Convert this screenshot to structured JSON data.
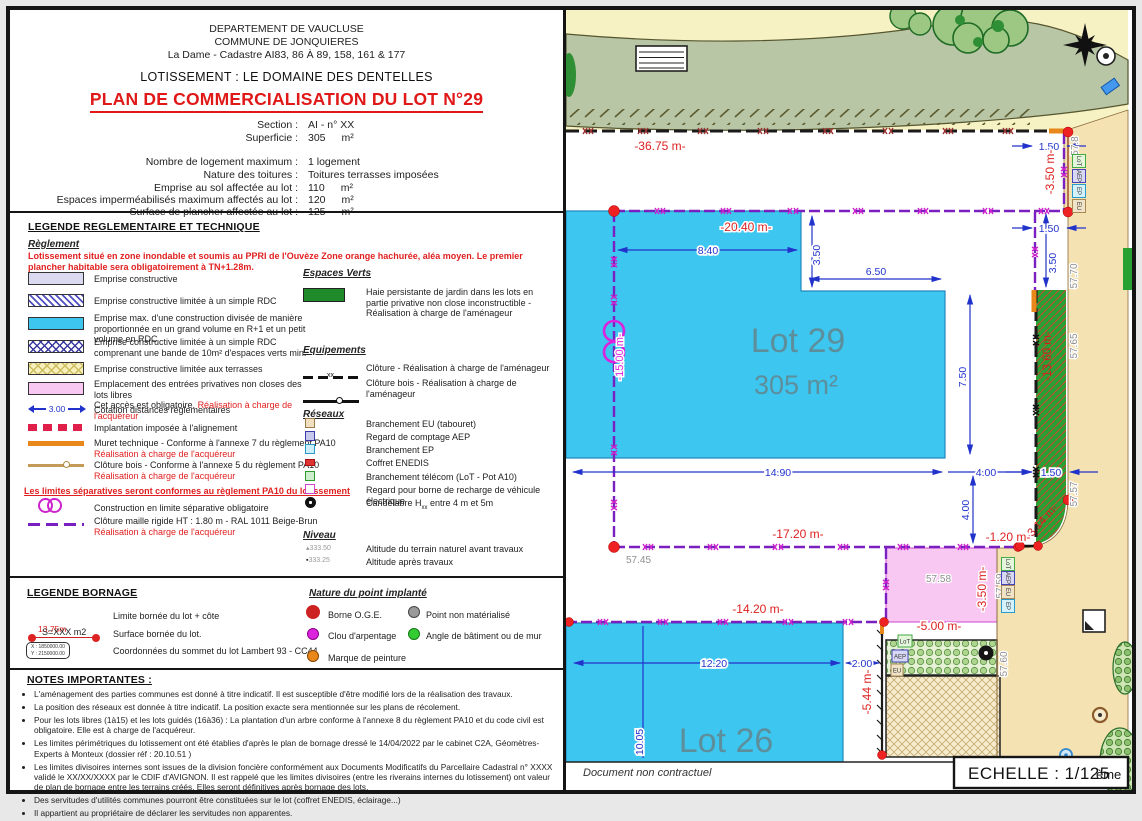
{
  "doc": {
    "dept": "DEPARTEMENT DE VAUCLUSE",
    "commune": "COMMUNE DE JONQUIERES",
    "cadastre": "La Dame - Cadastre AI83, 86 À 89, 158, 161 & 177",
    "lotissement": "LOTISSEMENT : LE DOMAINE DES DENTELLES",
    "title": "PLAN DE COMMERCIALISATION DU LOT N°29",
    "fields": [
      {
        "label": "Section :",
        "value": "AI - n° XX",
        "unit": ""
      },
      {
        "label": "Superficie :",
        "value": "305",
        "unit": "m²"
      },
      {
        "label": "Nombre de logement maximum :",
        "value": "1 logement",
        "unit": ""
      },
      {
        "label": "Nature des toitures :",
        "value": "Toitures terrasses imposées",
        "unit": ""
      },
      {
        "label": "Emprise au sol affectée au lot :",
        "value": "110",
        "unit": "m²"
      },
      {
        "label": "Espaces imperméabilisés maximum affectés au lot :",
        "value": "120",
        "unit": "m²"
      },
      {
        "label": "Surface de plancher affectée au lot :",
        "value": "125",
        "unit": "m²"
      }
    ]
  },
  "legend_tech": {
    "title": "LEGENDE REGLEMENTAIRE ET TECHNIQUE",
    "reglement_title": "Règlement",
    "warning": "Lotissement situé en zone inondable et soumis au PPRI de l'Ouvèze Zone orange hachurée, aléa moyen.  Le premier plancher habitable sera obligatoirement à TN+1.28m.",
    "cotation_value": "3.00",
    "items": [
      {
        "text": "Emprise constructive"
      },
      {
        "text": "Emprise constructive limitée à un simple RDC"
      },
      {
        "text": "Emprise max. d'une construction divisée de manière proportionnée en un grand volume en R+1 et un petit volume en RDC"
      },
      {
        "text": "Emprise constructive limitée à un simple RDC comprenant une bande de 10m² d'espaces verts min."
      },
      {
        "text": "Emprise constructive limitée aux terrasses"
      },
      {
        "text": "Emplacement des entrées privatives non closes des lots libres",
        "text2": "Cet accès est obligatoire. ",
        "red": "Réalisation à charge de l'acquéreur"
      },
      {
        "text": "Cotation distances réglementaires"
      },
      {
        "text": "Implantation imposée à l'alignement"
      },
      {
        "text": "Muret technique - Conforme à l'annexe 7 du règlement PA10",
        "red": "Réalisation à charge de l'acquéreur"
      },
      {
        "text": "Clôture bois - Conforme à l'annexe 5 du règlement PA10",
        "red": "Réalisation à charge de l'acquéreur"
      },
      {
        "text": "Construction en limite séparative obligatoire"
      },
      {
        "text": "Clôture maille rigide HT : 1.80 m - RAL 1011 Beige-Brun",
        "red": "Réalisation à charge de l'acquéreur"
      }
    ],
    "sep_note": "Les limites séparatives seront conformes au règlement PA10 du lotissement",
    "espaces_verts": {
      "title": "Espaces Verts",
      "haie": "Haie persistante de jardin dans les lots en partie privative non close inconstructible - Réalisation à charge de l'aménageur"
    },
    "equipements": {
      "title": "Equipements",
      "cloture": "Clôture - Réalisation à charge de l'aménageur",
      "cloture_bois": "Clôture bois - Réalisation à charge de l'aménageur"
    },
    "reseaux": {
      "title": "Réseaux",
      "eu": "Branchement EU (tabouret)",
      "aep": "Regard de comptage AEP",
      "ep": "Branchement EP",
      "enedis": "Coffret ENEDIS",
      "telecom": "Branchement télécom (LoT - Pot A10)",
      "recharge": "Regard pour borne de recharge de véhicule électrique",
      "cand_pre": "Candélabre H",
      "cand_sub": "xx",
      "cand_post": " entre 4 m et 5m"
    },
    "niveau": {
      "title": "Niveau",
      "avant_mark": "333.50",
      "avant": "Altitude du terrain naturel avant travaux",
      "apres_mark": "333.25",
      "apres": "Altitude après travaux"
    }
  },
  "nature_point": {
    "title": "Nature du point implanté",
    "borne": "Borne O.G.E.",
    "clou": "Clou d'arpentage",
    "marque": "Marque de peinture",
    "non_materialise": "Point non matérialisé",
    "angle": "Angle de bâtiment ou de mur"
  },
  "bornage": {
    "title": "LEGENDE BORNAGE",
    "limite_mark": "13.75m",
    "limite": "Limite bornée du lot + côte",
    "surface_mark": "S=XXX m2",
    "surface": "Surface bornée du lot.",
    "coord_x": "X : 1850000.00",
    "coord_y": "Y : 2150000.00",
    "coords": "Coordonnées du sommet du lot Lambert 93 - CC44"
  },
  "notes": {
    "title": "NOTES IMPORTANTES :",
    "bullets": [
      "L'aménagement des parties communes est donné à titre indicatif. Il est susceptible d'être modifié lors de la réalisation des travaux.",
      "La position des réseaux est donnée à titre indicatif. La position exacte sera mentionnée sur les plans de récolement.",
      "Pour les lots libres (1à15) et les lots guidés (16à36) : La plantation d'un arbre conforme à l'annexe 8 du règlement PA10 et du code civil est obligatoire. Elle est à charge de l'acquéreur.",
      "Les limites périmétriques du lotissement ont été établies d'après le plan de bornage dressé le 14/04/2022 par le cabinet C2A, Géomètres-Experts à Monteux (dossier réf : 20.10.51 )",
      "Les limites divisoires internes sont issues de la division foncière conformément aux Documents Modificatifs du Parcellaire Cadastral n° XXXX validé le XX/XX/XXXX par le CDIF d'AVIGNON. Il est rappelé que les limites divisoires (entre les riverains internes du lotissement) ont valeur de plan de bornage entre les terrains créés. Elles seront définitives après bornage des lots.",
      "Des servitudes d'utilités communes pourront être constituées sur le lot (coffret ENEDIS, éclairage...)",
      "Il appartient au propriétaire de déclarer les servitudes non apparentes."
    ]
  },
  "map": {
    "lot29": {
      "name": "Lot 29",
      "area": "305 m²"
    },
    "lot26": {
      "name": "Lot 26"
    },
    "icons": {
      "lot": "LoT",
      "aep": "AEP",
      "ep": "EP",
      "eu": "EU"
    },
    "labels": {
      "d3675": "-36.75 m-",
      "d2040": "-20.40 m-",
      "d1720": "-17.20 m-",
      "d1420": "-14.20 m-",
      "d500": "-5.00 m-",
      "d120": "-1.20 m-",
      "dcurve": "-3.14 m-",
      "vm350a": "-3.50 m-",
      "vm350b": "-3.50 m-",
      "vm1360": "-13.60 m-",
      "vm1500": "-15.00 m-",
      "v544": "-5.44 m-",
      "d840": "8.40",
      "v350a": "3.50",
      "v350b": "3.50",
      "d650": "6.50",
      "v750": "7.50",
      "d1490": "14.90",
      "d400h": "4.00",
      "v400": "4.00",
      "d150a": "1.50",
      "d150b": "1.50",
      "d150c": "1.50",
      "d1220": "12.20",
      "d200": "2.00",
      "v1005": "10.05",
      "a578": "57.8",
      "a5770": "57.70",
      "a5765": "57.65",
      "a5757": "57.57",
      "a5745": "57.45",
      "a5758": "57.58",
      "a5759": "57.59",
      "a5760": "57.60"
    },
    "colors": {
      "emprise_cyan": "#3cc6f0",
      "entree_pink": "#f8c8f2",
      "haie_green": "#28a032",
      "fence_purple": "#7a1fc0",
      "dim_blue": "#2233cc",
      "dim_red": "#dd2222",
      "road_green": "#b9c6a6",
      "street_tan": "#f4e2b2"
    }
  },
  "footer": {
    "disclaimer": "Document non contractuel",
    "scale": "ECHELLE : 1/125",
    "scale_suffix": "ème"
  }
}
